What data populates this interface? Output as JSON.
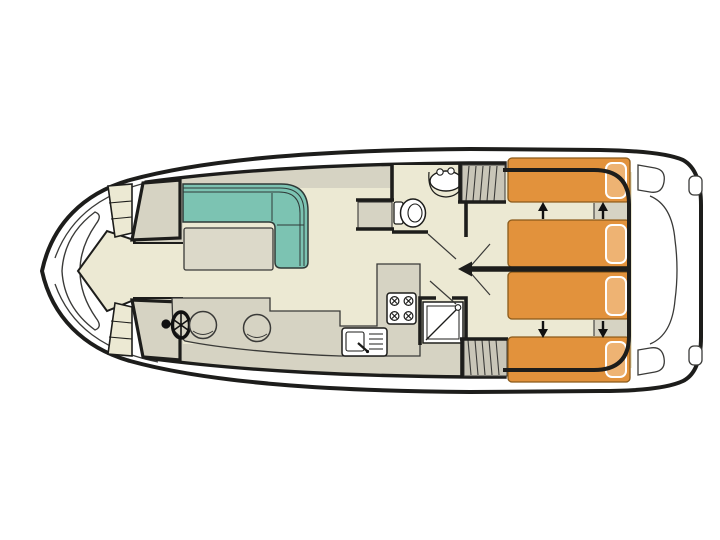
{
  "meta": {
    "title": "houseboat-deck-plan",
    "diagram_type": "boat floor plan, top view, bow left / stern right"
  },
  "colors": {
    "line": "#1d1d1b",
    "thin_line": "#3a3a38",
    "hull_white": "#ffffff",
    "deck_gray": "#d6d3c3",
    "stairs_gray": "#c9c6b8",
    "floor_cream": "#ece9d3",
    "sofa_teal": "#7cc3b2",
    "sofa_edge": "#2f6e62",
    "table_gray": "#dcd9c9",
    "bed_orange": "#e2923c",
    "bed_edge": "#8a5a1a",
    "pillow_orange": "#eeb373",
    "white": "#ffffff",
    "black": "#111111"
  },
  "features": {
    "bed_count": 4,
    "cabin_count": 2,
    "stove_burner_count": 4,
    "stool_count": 2,
    "stairway_count": 2,
    "bed_arrow_directions": [
      "up",
      "up",
      "down",
      "down"
    ]
  }
}
